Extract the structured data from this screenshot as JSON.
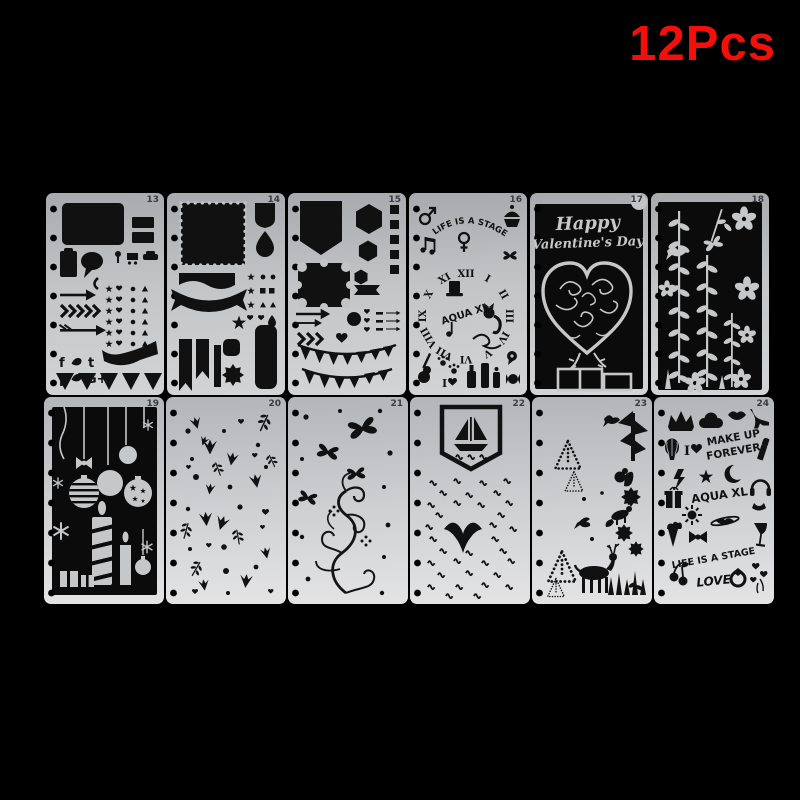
{
  "badge": {
    "label": "12Pcs"
  },
  "colors": {
    "background": "#000000",
    "badge_red": "#f3100a",
    "stencil_gray": "#c2c4c6",
    "cutout_black": "#111111",
    "art_gray": "#c6c7c9",
    "number_gray": "#3a3c40"
  },
  "stencils": [
    {
      "number": "13",
      "social": [
        "f",
        "t",
        "p",
        "G+"
      ],
      "icons": [
        "rounded-frame",
        "label-bars",
        "clipboard",
        "speech-bubble",
        "pushpin",
        "shopping-cart",
        "car",
        "phone",
        "arrow",
        "chevrons",
        "feather-arrow",
        "star-heart-dot-triangle-grid",
        "social-letters",
        "ribbon-banner",
        "triangle-row"
      ]
    },
    {
      "number": "14",
      "icons": [
        "scalloped-frame",
        "shield",
        "teardrop",
        "banner",
        "ribbon",
        "stars",
        "shape-grid",
        "pennants",
        "bar",
        "rounded-square",
        "starburst",
        "tall-label"
      ]
    },
    {
      "number": "15",
      "icons": [
        "pointed-banner",
        "hexagons",
        "square-column",
        "ornate-frame",
        "ribbon",
        "arrows",
        "circle",
        "hearts",
        "dashes",
        "mini-arrows",
        "chevrons",
        "heart",
        "bunting-flags"
      ]
    },
    {
      "number": "16",
      "arc_text": "LIFE IS A STAGE",
      "brand": "AQUA XL",
      "i_heart": "I",
      "clock_numerals": [
        "XII",
        "I",
        "II",
        "III",
        "IV",
        "V",
        "VI",
        "VII",
        "VIII",
        "IX",
        "X",
        "XI"
      ],
      "icons": [
        "male-symbol",
        "music-notes",
        "female-symbol",
        "cupcake",
        "butterfly",
        "top-hat",
        "cat",
        "flourish",
        "paw-prints",
        "guitar",
        "heart",
        "bottles",
        "candy",
        "speech-pin"
      ]
    },
    {
      "number": "17",
      "line1": "Happy",
      "line2": "Valentine's Day",
      "icons": [
        "filigree-heart",
        "gift-boxes",
        "stems"
      ]
    },
    {
      "number": "18",
      "icons": [
        "flowers",
        "leaf-vines",
        "fern",
        "bird",
        "butterfly"
      ]
    },
    {
      "number": "19",
      "icons": [
        "hanging-strings",
        "striped-bauble",
        "baubles",
        "star-bauble",
        "bow",
        "snowflakes",
        "striped-candle",
        "candle",
        "gift-boxes"
      ]
    },
    {
      "number": "20",
      "icons": [
        "tulips",
        "hearts",
        "dots",
        "leaf-sprigs"
      ]
    },
    {
      "number": "21",
      "icons": [
        "butterflies",
        "swirl-flourish",
        "dots"
      ]
    },
    {
      "number": "22",
      "icons": [
        "bookmark-banner",
        "sailboat",
        "waves",
        "whale-tail"
      ]
    },
    {
      "number": "23",
      "icons": [
        "dotted-trees",
        "deer",
        "squirrel",
        "fox",
        "bird",
        "tree",
        "flower-bursts",
        "grass"
      ]
    },
    {
      "number": "24",
      "line1": "MAKE UP",
      "line2": "FOREVER",
      "brand": "AQUA XL",
      "stage_text": "LIFE IS A STAGE",
      "love": "LOVE",
      "i_heart": "I",
      "icons": [
        "crown",
        "cloud",
        "lips",
        "high-heel",
        "hot-air-balloon",
        "lipstick",
        "lightning",
        "star",
        "moon",
        "gift",
        "sun",
        "headphones",
        "ice-cream-cone",
        "bow",
        "saturn-lips",
        "wine-glass",
        "cherries",
        "ring",
        "heart-balloons"
      ]
    }
  ]
}
